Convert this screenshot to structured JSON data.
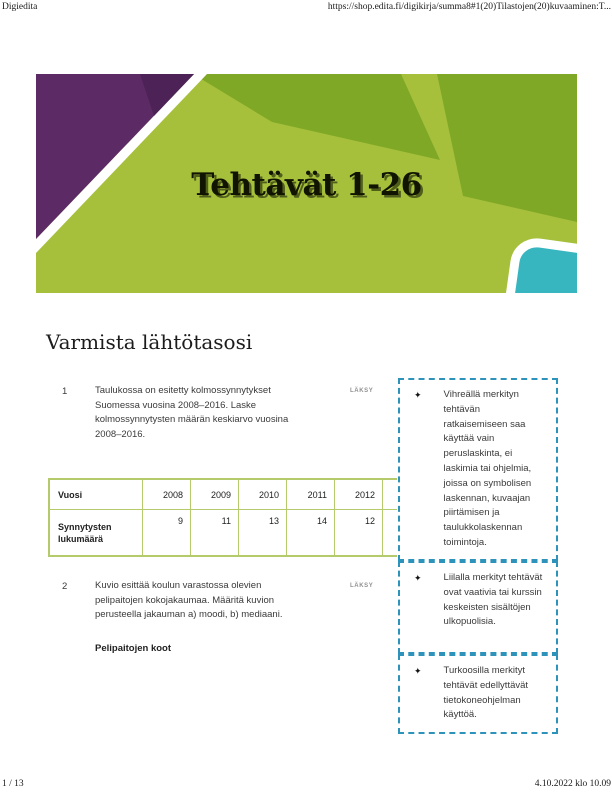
{
  "print": {
    "header_left": "Digiedita",
    "header_right": "https://shop.edita.fi/digikirja/summa8#1(20)Tilastojen(20)kuvaaminen:T...",
    "footer_page": "1 / 13",
    "footer_timestamp": "4.10.2022 klo 10.09"
  },
  "banner": {
    "title": "Tehtävät 1-26",
    "colors": {
      "light_green": "#a6c03c",
      "dark_green": "#80a827",
      "purple": "#5c2a64",
      "purple_dark": "#4c2257",
      "teal": "#38b6c0",
      "stripe_white": "#ffffff"
    }
  },
  "content": {
    "section_title": "Varmista lähtötasosi",
    "tasks": [
      {
        "number": "1",
        "text": "Taulukossa on esitetty kolmossynnytykset Suomessa vuosina 2008–2016. Laske kolmossynnytysten määrän keskiarvo vuosina 2008–2016.",
        "tag": "LÄKSY"
      },
      {
        "number": "2",
        "text": "Kuvio esittää koulun varastossa olevien pelipaitojen kokojakaumaa. Määritä kuvion perusteella jakauman a) moodi, b) mediaani.",
        "tag": "LÄKSY",
        "subtitle": "Pelipaitojen koot"
      }
    ],
    "table": {
      "label_header": "Vuosi",
      "label_data": "Synnytysten lukumäärä",
      "columns": [
        {
          "year": "2008",
          "value": "9"
        },
        {
          "year": "2009",
          "value": "11"
        },
        {
          "year": "2010",
          "value": "13"
        },
        {
          "year": "2011",
          "value": "14"
        },
        {
          "year": "2012",
          "value": "12"
        },
        {
          "year": "2013",
          "value": "7"
        },
        {
          "year": "2014",
          "value": "7"
        }
      ],
      "border_color": "#b5cb6b"
    }
  },
  "sidebar": {
    "bullet": "✦",
    "border_color": "#2e93ba",
    "notes": [
      {
        "text": "Vihreällä merkityn tehtävän ratkaisemiseen saa käyttää vain peruslaskinta, ei laskimia tai ohjelmia, joissa on symbolisen laskennan, kuvaajan piirtämisen ja taulukkolaskennan toimintoja."
      },
      {
        "text": "Liilalla merkityt tehtävät ovat vaativia tai kurssin keskeisten sisältöjen ulkopuolisia."
      },
      {
        "text": "Turkoosilla merkityt tehtävät edellyttävät tietokoneohjelman käyttöä."
      }
    ]
  }
}
